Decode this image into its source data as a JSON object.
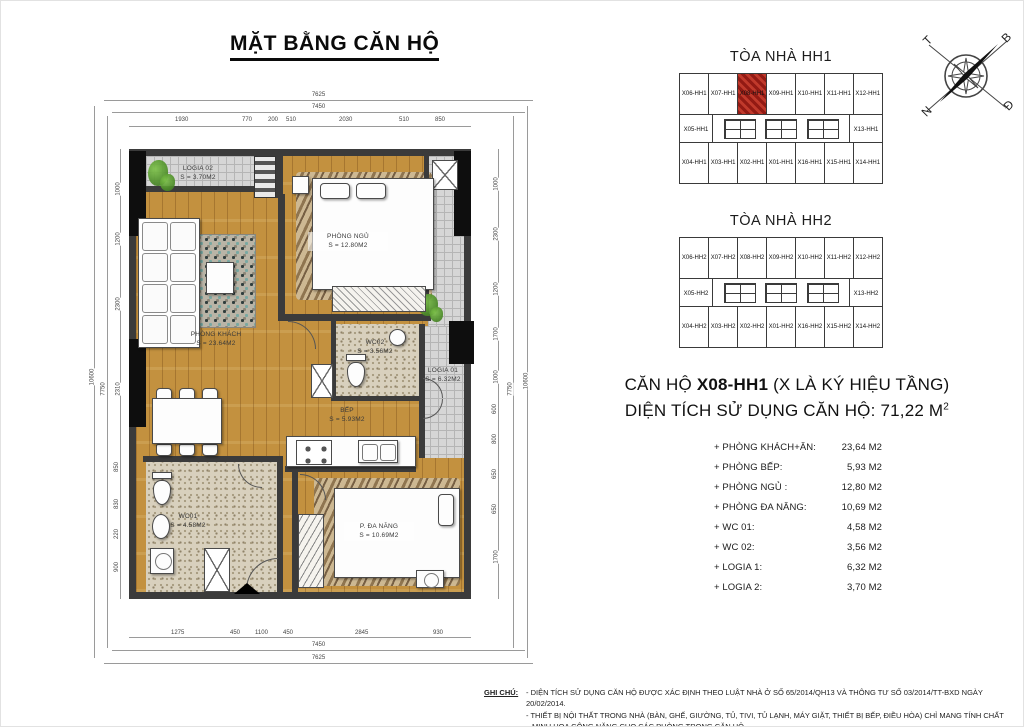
{
  "title": "MẶT BẰNG CĂN HỘ",
  "compass": {
    "west": "T",
    "north": "B",
    "south": "N",
    "east": "Đ"
  },
  "plan": {
    "rooms": {
      "logia2": {
        "name": "LOGIA 02",
        "area": "S = 3.70M2"
      },
      "bedroom": {
        "name": "PHÒNG NGỦ",
        "area": "S = 12.80M2"
      },
      "living": {
        "name": "PHÒNG KHÁCH",
        "area": "S = 23.64M2"
      },
      "wc2": {
        "name": "WC02",
        "area": "S = 3.56M2"
      },
      "logia1": {
        "name": "LOGIA 01",
        "area": "S = 6.32M2"
      },
      "kitchen": {
        "name": "BẾP",
        "area": "S = 5.93M2"
      },
      "wc1": {
        "name": "WC01",
        "area": "S = 4.58M2"
      },
      "multi": {
        "name": "P. ĐA NĂNG",
        "area": "S = 10.69M2"
      }
    },
    "dims": {
      "top_total": "7625",
      "top_inner": "7450",
      "bottom_total": "7625",
      "bottom_inner": "7450",
      "left_total": "10600",
      "left_inner": "7750",
      "right_total": "10600",
      "right_inner": "7750",
      "top_segments": [
        "1930",
        "770",
        "200",
        "510",
        "2030",
        "510",
        "850"
      ],
      "bottom_segments": [
        "1275",
        "450",
        "1100",
        "450",
        "2845",
        "930"
      ],
      "left_segments": [
        "1000",
        "1200",
        "2300",
        "2310",
        "850",
        "830",
        "220",
        "900"
      ],
      "right_segments": [
        "1000",
        "2300",
        "1200",
        "1700",
        "1000",
        "600",
        "800",
        "650",
        "650",
        "1700"
      ]
    }
  },
  "buildings": [
    {
      "title": "TÒA NHÀ HH1",
      "top": [
        "X06-HH1",
        "X07-HH1",
        "X08-HH1",
        "X09-HH1",
        "X10-HH1",
        "X11-HH1",
        "X12-HH1"
      ],
      "mid_left": "X05-HH1",
      "mid_right": "X13-HH1",
      "bottom": [
        "X04-HH1",
        "X03-HH1",
        "X02-HH1",
        "X01-HH1",
        "X16-HH1",
        "X15-HH1",
        "X14-HH1"
      ],
      "highlight": "X08-HH1"
    },
    {
      "title": "TÒA NHÀ HH2",
      "top": [
        "X06-HH2",
        "X07-HH2",
        "X08-HH2",
        "X09-HH2",
        "X10-HH2",
        "X11-HH2",
        "X12-HH2"
      ],
      "mid_left": "X05-HH2",
      "mid_right": "X13-HH2",
      "bottom": [
        "X04-HH2",
        "X03-HH2",
        "X02-HH2",
        "X01-HH2",
        "X16-HH2",
        "X15-HH2",
        "X14-HH2"
      ]
    }
  ],
  "info": {
    "prefix": "CĂN HỘ ",
    "unit": "X08-HH1",
    "suffix": " (X LÀ KÝ HIỆU TẦNG)",
    "area_label": "DIỆN TÍCH SỬ DỤNG CĂN HỘ: 71,22 M",
    "area_sup": "2"
  },
  "room_list": [
    {
      "label": "+ PHÒNG KHÁCH+ĂN:",
      "value": "23,64 M2"
    },
    {
      "label": "+ PHÒNG BẾP:",
      "value": "5,93 M2"
    },
    {
      "label": "+ PHÒNG NGỦ :",
      "value": "12,80 M2"
    },
    {
      "label": "+ PHÒNG ĐA NĂNG:",
      "value": "10,69 M2"
    },
    {
      "label": "+ WC 01:",
      "value": "4,58 M2"
    },
    {
      "label": "+ WC 02:",
      "value": "3,56 M2"
    },
    {
      "label": "+ LOGIA 1:",
      "value": "6,32 M2"
    },
    {
      "label": "+ LOGIA 2:",
      "value": "3,70 M2"
    }
  ],
  "note": {
    "label": "GHI CHÚ:",
    "line1": "- DIỆN TÍCH SỬ DỤNG CĂN HỘ ĐƯỢC XÁC ĐỊNH THEO LUẬT NHÀ Ở SỐ 65/2014/QH13 VÀ THÔNG TƯ SỐ 03/2014/TT-BXD NGÀY 20/02/2014.",
    "line2": "- THIẾT BỊ NỘI THẤT TRONG NHÀ (BÀN, GHẾ, GIƯỜNG, TỦ, TIVI, TỦ LẠNH, MÁY GIẶT, THIẾT BỊ BẾP, ĐIỀU HÒA)  CHỈ MANG TÍNH CHẤT",
    "line3": "MINH HỌA CÔNG NĂNG CHO CÁC PHÒNG TRONG CĂN HỘ"
  },
  "colors": {
    "unit_highlight": "#c0392b",
    "wall": "#3b3b3b",
    "wood_floor": "#c3913f",
    "tile_gray": "#d6d6d6",
    "tile_beige": "#d8d0bd"
  }
}
